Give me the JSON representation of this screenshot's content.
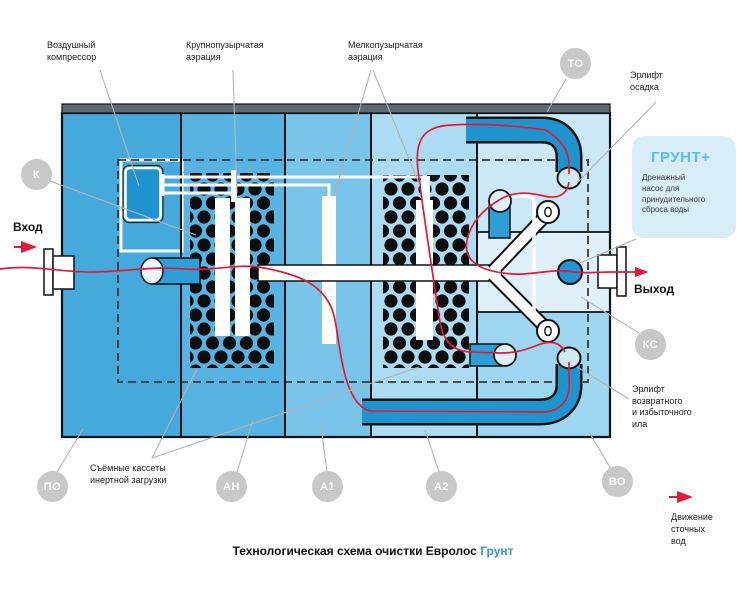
{
  "diagram_title": {
    "black": "Технологическая схема очистки Евролос ",
    "blue": "Грунт"
  },
  "callouts": {
    "air_compressor": "Воздушный\nкомпрессор",
    "coarse_aeration": "Крупнопузырчатая\nаэрация",
    "fine_aeration": "Мелкопузырчатая\nаэрация",
    "sludge_airlift": "Эрлифт\nосадка",
    "return_sludge_airlift": "Эрлифт\nвозвратного\nи избыточного\nила",
    "removable_cassettes": "Съёмные кассеты\nинертной загрузки",
    "inlet": "Вход",
    "outlet": "Выход",
    "flow_legend": "Движение\nсточных\nвод"
  },
  "grunt_plus": {
    "title": "ГРУНТ+",
    "description": "Дренажный\nнасос для\nпринудительного\nсброса воды"
  },
  "badges": {
    "k": "К",
    "to": "ТО",
    "ks": "КС",
    "vo": "ВО",
    "po": "ПО",
    "an": "АН",
    "a1": "А1",
    "a2": "А2"
  },
  "colors": {
    "flow_red": "#e41937",
    "pipe_blue": "#1f95cf",
    "ball_blue": "#2196d4",
    "badge_gray": "#c8c8c8",
    "grunt_title_blue": "#55bfee",
    "title_accent_blue": "#2f99d5",
    "chamber_1": "#45a9dc",
    "chamber_2": "#57b3e1",
    "chamber_3": "#79c4e9",
    "chamber_4": "#abdcf3",
    "chamber_5_top": "#cbe8f7",
    "chamber_5_mid": "#dff0fb",
    "chamber_5_bottom": "#9ed6f1"
  }
}
